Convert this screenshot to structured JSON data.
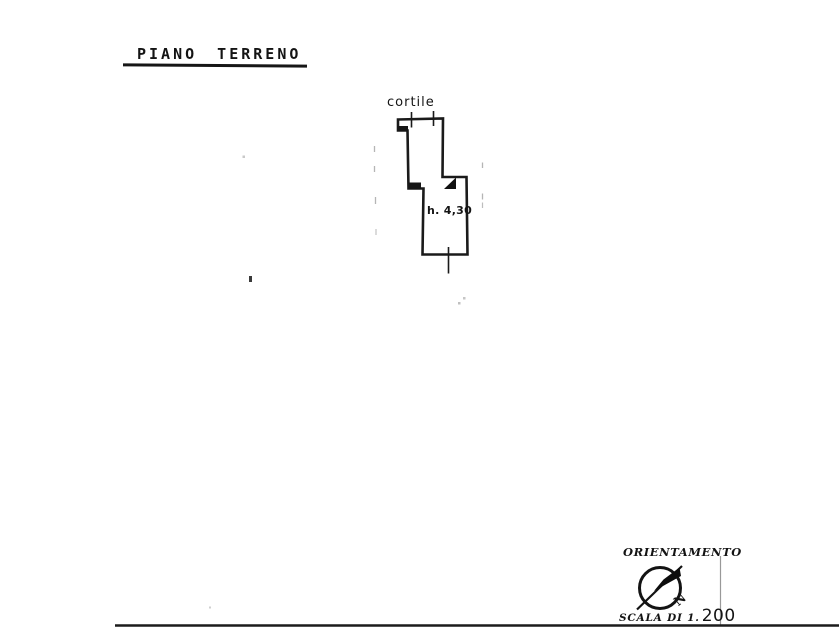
{
  "page": {
    "background_color": "#ffffff",
    "ink_color": "#161616",
    "faint_mark_color": "#b5b5b5"
  },
  "title": {
    "text": "PIANO TERRENO"
  },
  "plan": {
    "courtyard_label": "cortile",
    "room_height_label": "h. 4,30"
  },
  "title_block": {
    "orientation_label": "ORIENTAMENTO",
    "compass_north_label": "N",
    "scale_prefix": "SCALA DI 1.",
    "scale_value": "200"
  }
}
